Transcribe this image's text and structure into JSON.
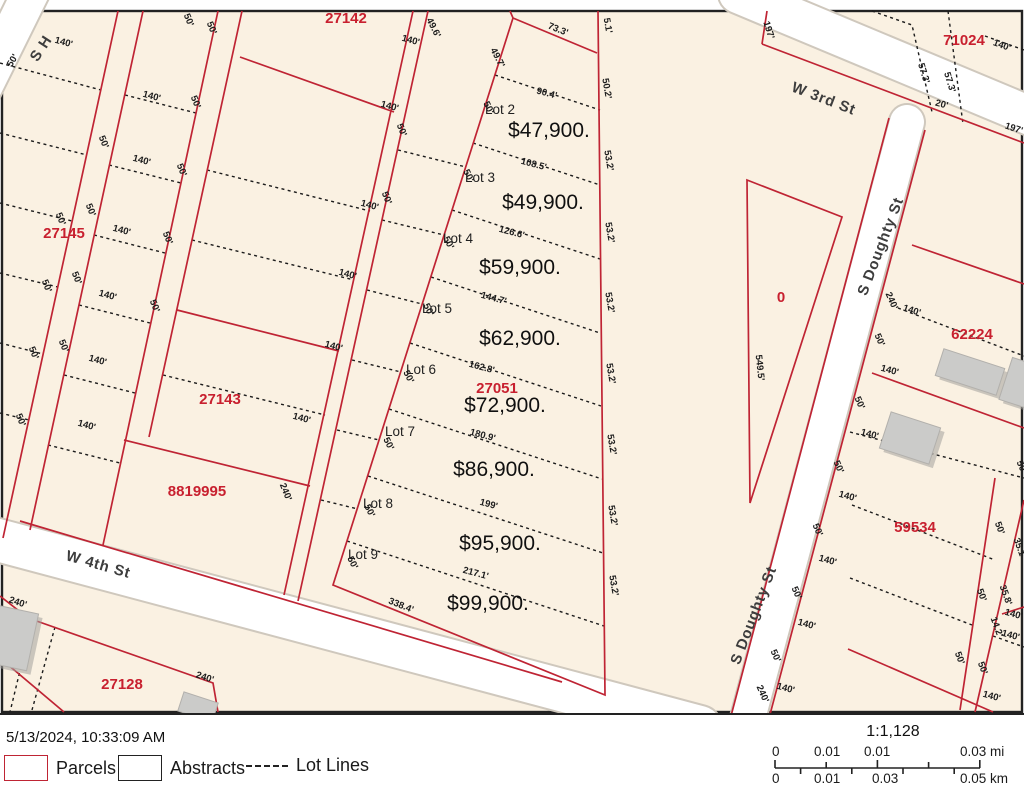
{
  "colors": {
    "map_background": "#faf1e2",
    "parcel_line": "#bf2434",
    "parcel_id_text": "#c8202f",
    "road_fill": "#ffffff",
    "lot_line": "#1b1b1b",
    "building_fill": "#cbcbc9"
  },
  "footer": {
    "timestamp": "5/13/2024, 10:33:09 AM",
    "legend": {
      "parcels": "Parcels",
      "abstracts": "Abstracts",
      "lot_lines": "Lot Lines"
    },
    "scalebar": {
      "ratio": "1:1,128",
      "mi_labels": [
        "0",
        "0.01",
        "0.01",
        "0.03 mi"
      ],
      "km_labels": [
        "0",
        "0.01",
        "0.03",
        "0.05 km"
      ]
    }
  },
  "map": {
    "streets": [
      "W 3rd St",
      "S Doughty St",
      "W 4th St",
      "S H"
    ],
    "parcel_ids": [
      "27142",
      "27145",
      "27143",
      "8819995",
      "27128",
      "27051",
      "71024",
      "62224",
      "59534",
      "0"
    ],
    "lot_listings": [
      {
        "lot": "Lot 2",
        "price": "$47,900.",
        "frontage": "90.4'"
      },
      {
        "lot": "Lot 3",
        "price": "$49,900.",
        "frontage": "108.5'"
      },
      {
        "lot": "Lot 4",
        "price": "$59,900.",
        "frontage": "126.6'"
      },
      {
        "lot": "Lot 5",
        "price": "$62,900.",
        "frontage": "144.7'"
      },
      {
        "lot": "Lot 6",
        "price": "$72,900.",
        "frontage": "162.8'"
      },
      {
        "lot": "Lot 7",
        "price": "$86,900.",
        "frontage": "180.9'"
      },
      {
        "lot": "Lot 8",
        "price": "$95,900.",
        "frontage": "199'"
      },
      {
        "lot": "Lot 9",
        "price": "$99,900.",
        "frontage": "217.1'"
      }
    ],
    "labels": [
      {
        "t": "W 3rd St",
        "x": 822,
        "y": 103,
        "r": 21,
        "c": "street",
        "n": "street-label-w-3rd-st"
      },
      {
        "t": "S Doughty St",
        "x": 885,
        "y": 248,
        "r": -69,
        "c": "street",
        "n": "street-label-s-doughty-st"
      },
      {
        "t": "S Doughty St",
        "x": 758,
        "y": 617,
        "r": -69,
        "c": "street",
        "n": "street-label-s-doughty-st-2"
      },
      {
        "t": "W 4th St",
        "x": 97,
        "y": 569,
        "r": 16,
        "c": "street",
        "n": "street-label-w-4th-st"
      },
      {
        "t": "S H",
        "x": 45,
        "y": 51,
        "r": -57,
        "c": "street",
        "n": "street-label-s-h"
      },
      {
        "t": "27142",
        "x": 346,
        "y": 23,
        "r": 0,
        "c": "pid",
        "n": "parcel-id-27142"
      },
      {
        "t": "27145",
        "x": 64,
        "y": 238,
        "r": 0,
        "c": "pid",
        "n": "parcel-id-27145"
      },
      {
        "t": "27143",
        "x": 220,
        "y": 404,
        "r": 0,
        "c": "pid",
        "n": "parcel-id-27143"
      },
      {
        "t": "8819995",
        "x": 197,
        "y": 496,
        "r": 0,
        "c": "pid",
        "n": "parcel-id-8819995"
      },
      {
        "t": "27128",
        "x": 122,
        "y": 689,
        "r": 0,
        "c": "pid",
        "n": "parcel-id-27128"
      },
      {
        "t": "27051",
        "x": 497,
        "y": 393,
        "r": 0,
        "c": "pid",
        "n": "parcel-id-27051"
      },
      {
        "t": "71024",
        "x": 964,
        "y": 45,
        "r": 0,
        "c": "pid",
        "n": "parcel-id-71024"
      },
      {
        "t": "62224",
        "x": 972,
        "y": 339,
        "r": 0,
        "c": "pid",
        "n": "parcel-id-62224"
      },
      {
        "t": "59534",
        "x": 915,
        "y": 532,
        "r": 0,
        "c": "pid",
        "n": "parcel-id-59534"
      },
      {
        "t": "0",
        "x": 781,
        "y": 302,
        "r": 0,
        "c": "pid",
        "n": "parcel-id-0"
      },
      {
        "t": "Lot 2",
        "x": 500,
        "y": 114,
        "r": 0,
        "c": "lot",
        "n": "lot-2-label"
      },
      {
        "t": "Lot 3",
        "x": 480,
        "y": 182,
        "r": 0,
        "c": "lot",
        "n": "lot-3-label"
      },
      {
        "t": "Lot 4",
        "x": 458,
        "y": 243,
        "r": 0,
        "c": "lot",
        "n": "lot-4-label"
      },
      {
        "t": "Lot 5",
        "x": 437,
        "y": 313,
        "r": 0,
        "c": "lot",
        "n": "lot-5-label"
      },
      {
        "t": "Lot 6",
        "x": 421,
        "y": 374,
        "r": 0,
        "c": "lot",
        "n": "lot-6-label"
      },
      {
        "t": "Lot 7",
        "x": 400,
        "y": 436,
        "r": 0,
        "c": "lot",
        "n": "lot-7-label"
      },
      {
        "t": "Lot 8",
        "x": 378,
        "y": 508,
        "r": 0,
        "c": "lot",
        "n": "lot-8-label"
      },
      {
        "t": "Lot 9",
        "x": 363,
        "y": 559,
        "r": 0,
        "c": "lot",
        "n": "lot-9-label"
      },
      {
        "t": "$47,900.",
        "x": 549,
        "y": 137,
        "r": 0,
        "c": "price",
        "n": "lot-2-price"
      },
      {
        "t": "$49,900.",
        "x": 543,
        "y": 209,
        "r": 0,
        "c": "price",
        "n": "lot-3-price"
      },
      {
        "t": "$59,900.",
        "x": 520,
        "y": 274,
        "r": 0,
        "c": "price",
        "n": "lot-4-price"
      },
      {
        "t": "$62,900.",
        "x": 520,
        "y": 345,
        "r": 0,
        "c": "price",
        "n": "lot-5-price"
      },
      {
        "t": "$72,900.",
        "x": 505,
        "y": 412,
        "r": 0,
        "c": "price",
        "n": "lot-6-price"
      },
      {
        "t": "$86,900.",
        "x": 494,
        "y": 476,
        "r": 0,
        "c": "price",
        "n": "lot-7-price"
      },
      {
        "t": "$95,900.",
        "x": 500,
        "y": 550,
        "r": 0,
        "c": "price",
        "n": "lot-8-price"
      },
      {
        "t": "$99,900.",
        "x": 488,
        "y": 610,
        "r": 0,
        "c": "price",
        "n": "lot-9-price"
      },
      {
        "t": "73.3'",
        "x": 557,
        "y": 32,
        "r": 22,
        "c": "dim",
        "n": "dim-label"
      },
      {
        "t": "5.1'",
        "x": 605,
        "y": 26,
        "r": 80,
        "c": "dim",
        "n": "dim-label"
      },
      {
        "t": "50.2'",
        "x": 604,
        "y": 89,
        "r": 80,
        "c": "dim",
        "n": "dim-label"
      },
      {
        "t": "53.2'",
        "x": 606,
        "y": 161,
        "r": 80,
        "c": "dim",
        "n": "dim-label"
      },
      {
        "t": "53.2'",
        "x": 607,
        "y": 233,
        "r": 80,
        "c": "dim",
        "n": "dim-label"
      },
      {
        "t": "53.2'",
        "x": 607,
        "y": 303,
        "r": 80,
        "c": "dim",
        "n": "dim-label"
      },
      {
        "t": "53.2'",
        "x": 608,
        "y": 374,
        "r": 80,
        "c": "dim",
        "n": "dim-label"
      },
      {
        "t": "53.2'",
        "x": 609,
        "y": 445,
        "r": 80,
        "c": "dim",
        "n": "dim-label"
      },
      {
        "t": "53.2'",
        "x": 610,
        "y": 516,
        "r": 80,
        "c": "dim",
        "n": "dim-label"
      },
      {
        "t": "53.2'",
        "x": 611,
        "y": 586,
        "r": 80,
        "c": "dim",
        "n": "dim-label"
      },
      {
        "t": "49.7'",
        "x": 495,
        "y": 59,
        "r": 63,
        "c": "dim",
        "n": "dim-label"
      },
      {
        "t": "49.6'",
        "x": 431,
        "y": 29,
        "r": 63,
        "c": "dim",
        "n": "dim-label"
      },
      {
        "t": "50'",
        "x": 486,
        "y": 109,
        "r": 63,
        "c": "dim",
        "n": "dim-label"
      },
      {
        "t": "50'",
        "x": 466,
        "y": 177,
        "r": 63,
        "c": "dim",
        "n": "dim-label"
      },
      {
        "t": "50'",
        "x": 446,
        "y": 244,
        "r": 63,
        "c": "dim",
        "n": "dim-label"
      },
      {
        "t": "50'",
        "x": 426,
        "y": 311,
        "r": 63,
        "c": "dim",
        "n": "dim-label"
      },
      {
        "t": "50'",
        "x": 406,
        "y": 378,
        "r": 63,
        "c": "dim",
        "n": "dim-label"
      },
      {
        "t": "50'",
        "x": 386,
        "y": 445,
        "r": 63,
        "c": "dim",
        "n": "dim-label"
      },
      {
        "t": "50'",
        "x": 367,
        "y": 512,
        "r": 63,
        "c": "dim",
        "n": "dim-label"
      },
      {
        "t": "50'",
        "x": 350,
        "y": 564,
        "r": 63,
        "c": "dim",
        "n": "dim-label"
      },
      {
        "t": "90.4'",
        "x": 546,
        "y": 96,
        "r": 15,
        "c": "dim",
        "n": "dim-label"
      },
      {
        "t": "108.5'",
        "x": 533,
        "y": 167,
        "r": 15,
        "c": "dim",
        "n": "dim-label"
      },
      {
        "t": "126.6'",
        "x": 511,
        "y": 235,
        "r": 15,
        "c": "dim",
        "n": "dim-label"
      },
      {
        "t": "144.7'",
        "x": 493,
        "y": 301,
        "r": 15,
        "c": "dim",
        "n": "dim-label"
      },
      {
        "t": "162.8'",
        "x": 481,
        "y": 370,
        "r": 15,
        "c": "dim",
        "n": "dim-label"
      },
      {
        "t": "180.9'",
        "x": 482,
        "y": 438,
        "r": 15,
        "c": "dim",
        "n": "dim-label"
      },
      {
        "t": "199'",
        "x": 488,
        "y": 507,
        "r": 15,
        "c": "dim",
        "n": "dim-label"
      },
      {
        "t": "217.1'",
        "x": 475,
        "y": 576,
        "r": 15,
        "c": "dim",
        "n": "dim-label"
      },
      {
        "t": "338.4'",
        "x": 400,
        "y": 608,
        "r": 22,
        "c": "dim",
        "n": "dim-label"
      },
      {
        "t": "140'",
        "x": 63,
        "y": 45,
        "r": 15,
        "c": "dim",
        "n": "dim-label"
      },
      {
        "t": "140'",
        "x": 151,
        "y": 99,
        "r": 15,
        "c": "dim",
        "n": "dim-label"
      },
      {
        "t": "140'",
        "x": 141,
        "y": 163,
        "r": 15,
        "c": "dim",
        "n": "dim-label"
      },
      {
        "t": "140'",
        "x": 121,
        "y": 233,
        "r": 15,
        "c": "dim",
        "n": "dim-label"
      },
      {
        "t": "140'",
        "x": 107,
        "y": 298,
        "r": 15,
        "c": "dim",
        "n": "dim-label"
      },
      {
        "t": "140'",
        "x": 97,
        "y": 363,
        "r": 15,
        "c": "dim",
        "n": "dim-label"
      },
      {
        "t": "140'",
        "x": 86,
        "y": 428,
        "r": 15,
        "c": "dim",
        "n": "dim-label"
      },
      {
        "t": "50'",
        "x": 15,
        "y": 62,
        "r": -58,
        "c": "dim",
        "n": "dim-label"
      },
      {
        "t": "50'",
        "x": 58,
        "y": 220,
        "r": 68,
        "c": "dim",
        "n": "dim-label"
      },
      {
        "t": "50'",
        "x": 44,
        "y": 287,
        "r": 68,
        "c": "dim",
        "n": "dim-label"
      },
      {
        "t": "50'",
        "x": 31,
        "y": 354,
        "r": 68,
        "c": "dim",
        "n": "dim-label"
      },
      {
        "t": "50'",
        "x": 18,
        "y": 421,
        "r": 68,
        "c": "dim",
        "n": "dim-label"
      },
      {
        "t": "50'",
        "x": 101,
        "y": 143,
        "r": 68,
        "c": "dim",
        "n": "dim-label"
      },
      {
        "t": "50'",
        "x": 88,
        "y": 211,
        "r": 68,
        "c": "dim",
        "n": "dim-label"
      },
      {
        "t": "50'",
        "x": 74,
        "y": 279,
        "r": 68,
        "c": "dim",
        "n": "dim-label"
      },
      {
        "t": "50'",
        "x": 61,
        "y": 347,
        "r": 68,
        "c": "dim",
        "n": "dim-label"
      },
      {
        "t": "50'",
        "x": 186,
        "y": 21,
        "r": 68,
        "c": "dim",
        "n": "dim-label"
      },
      {
        "t": "50'",
        "x": 209,
        "y": 29,
        "r": 68,
        "c": "dim",
        "n": "dim-label"
      },
      {
        "t": "50'",
        "x": 193,
        "y": 103,
        "r": 68,
        "c": "dim",
        "n": "dim-label"
      },
      {
        "t": "50'",
        "x": 179,
        "y": 171,
        "r": 68,
        "c": "dim",
        "n": "dim-label"
      },
      {
        "t": "50'",
        "x": 165,
        "y": 239,
        "r": 68,
        "c": "dim",
        "n": "dim-label"
      },
      {
        "t": "50'",
        "x": 152,
        "y": 307,
        "r": 68,
        "c": "dim",
        "n": "dim-label"
      },
      {
        "t": "140'",
        "x": 410,
        "y": 43,
        "r": 15,
        "c": "dim",
        "n": "dim-label"
      },
      {
        "t": "140'",
        "x": 389,
        "y": 109,
        "r": 15,
        "c": "dim",
        "n": "dim-label"
      },
      {
        "t": "140'",
        "x": 369,
        "y": 208,
        "r": 15,
        "c": "dim",
        "n": "dim-label"
      },
      {
        "t": "140'",
        "x": 347,
        "y": 277,
        "r": 15,
        "c": "dim",
        "n": "dim-label"
      },
      {
        "t": "140'",
        "x": 333,
        "y": 349,
        "r": 15,
        "c": "dim",
        "n": "dim-label"
      },
      {
        "t": "140'",
        "x": 301,
        "y": 421,
        "r": 15,
        "c": "dim",
        "n": "dim-label"
      },
      {
        "t": "50'",
        "x": 399,
        "y": 131,
        "r": 68,
        "c": "dim",
        "n": "dim-label"
      },
      {
        "t": "50'",
        "x": 384,
        "y": 199,
        "r": 68,
        "c": "dim",
        "n": "dim-label"
      },
      {
        "t": "240'",
        "x": 283,
        "y": 493,
        "r": 68,
        "c": "dim",
        "n": "dim-label"
      },
      {
        "t": "240'",
        "x": 17,
        "y": 605,
        "r": 18,
        "c": "dim",
        "n": "dim-label"
      },
      {
        "t": "240'",
        "x": 204,
        "y": 680,
        "r": 18,
        "c": "dim",
        "n": "dim-label"
      },
      {
        "t": "197'",
        "x": 766,
        "y": 31,
        "r": 72,
        "c": "dim",
        "n": "dim-label"
      },
      {
        "t": "57.3'",
        "x": 921,
        "y": 74,
        "r": 73,
        "c": "dim",
        "n": "dim-label"
      },
      {
        "t": "57.3'",
        "x": 947,
        "y": 83,
        "r": 73,
        "c": "dim",
        "n": "dim-label"
      },
      {
        "t": "20'",
        "x": 941,
        "y": 107,
        "r": 15,
        "c": "dim",
        "n": "dim-label"
      },
      {
        "t": "140'",
        "x": 1001,
        "y": 48,
        "r": 20,
        "c": "dim",
        "n": "dim-label"
      },
      {
        "t": "197'",
        "x": 1013,
        "y": 131,
        "r": 18,
        "c": "dim",
        "n": "dim-label"
      },
      {
        "t": "549.5'",
        "x": 757,
        "y": 368,
        "r": 84,
        "c": "dim",
        "n": "dim-label"
      },
      {
        "t": "240'",
        "x": 889,
        "y": 302,
        "r": 66,
        "c": "dim",
        "n": "dim-label"
      },
      {
        "t": "140'",
        "x": 911,
        "y": 313,
        "r": 18,
        "c": "dim",
        "n": "dim-label"
      },
      {
        "t": "50'",
        "x": 877,
        "y": 341,
        "r": 66,
        "c": "dim",
        "n": "dim-label"
      },
      {
        "t": "140'",
        "x": 889,
        "y": 373,
        "r": 15,
        "c": "dim",
        "n": "dim-label"
      },
      {
        "t": "50'",
        "x": 857,
        "y": 404,
        "r": 66,
        "c": "dim",
        "n": "dim-label"
      },
      {
        "t": "140'",
        "x": 869,
        "y": 437,
        "r": 15,
        "c": "dim",
        "n": "dim-label"
      },
      {
        "t": "50'",
        "x": 836,
        "y": 468,
        "r": 66,
        "c": "dim",
        "n": "dim-label"
      },
      {
        "t": "140'",
        "x": 847,
        "y": 499,
        "r": 15,
        "c": "dim",
        "n": "dim-label"
      },
      {
        "t": "50'",
        "x": 815,
        "y": 531,
        "r": 66,
        "c": "dim",
        "n": "dim-label"
      },
      {
        "t": "140'",
        "x": 827,
        "y": 563,
        "r": 15,
        "c": "dim",
        "n": "dim-label"
      },
      {
        "t": "50'",
        "x": 794,
        "y": 594,
        "r": 66,
        "c": "dim",
        "n": "dim-label"
      },
      {
        "t": "140'",
        "x": 806,
        "y": 627,
        "r": 15,
        "c": "dim",
        "n": "dim-label"
      },
      {
        "t": "50'",
        "x": 773,
        "y": 657,
        "r": 66,
        "c": "dim",
        "n": "dim-label"
      },
      {
        "t": "140'",
        "x": 785,
        "y": 691,
        "r": 15,
        "c": "dim",
        "n": "dim-label"
      },
      {
        "t": "240'",
        "x": 760,
        "y": 695,
        "r": 66,
        "c": "dim",
        "n": "dim-label"
      },
      {
        "t": "50'",
        "x": 1019,
        "y": 468,
        "r": 66,
        "c": "dim",
        "n": "dim-label"
      },
      {
        "t": "50'",
        "x": 997,
        "y": 529,
        "r": 70,
        "c": "dim",
        "n": "dim-label"
      },
      {
        "t": "35.1'",
        "x": 1017,
        "y": 549,
        "r": 70,
        "c": "dim",
        "n": "dim-label"
      },
      {
        "t": "50'",
        "x": 979,
        "y": 596,
        "r": 70,
        "c": "dim",
        "n": "dim-label"
      },
      {
        "t": "35.8'",
        "x": 1003,
        "y": 596,
        "r": 70,
        "c": "dim",
        "n": "dim-label"
      },
      {
        "t": "14.2'",
        "x": 994,
        "y": 628,
        "r": 70,
        "c": "dim",
        "n": "dim-label"
      },
      {
        "t": "140'",
        "x": 1013,
        "y": 617,
        "r": 15,
        "c": "dim",
        "n": "dim-label"
      },
      {
        "t": "140'",
        "x": 1010,
        "y": 638,
        "r": 15,
        "c": "dim",
        "n": "dim-label"
      },
      {
        "t": "50'",
        "x": 957,
        "y": 659,
        "r": 70,
        "c": "dim",
        "n": "dim-label"
      },
      {
        "t": "50'",
        "x": 980,
        "y": 669,
        "r": 70,
        "c": "dim",
        "n": "dim-label"
      },
      {
        "t": "140'",
        "x": 991,
        "y": 699,
        "r": 15,
        "c": "dim",
        "n": "dim-label"
      }
    ]
  }
}
